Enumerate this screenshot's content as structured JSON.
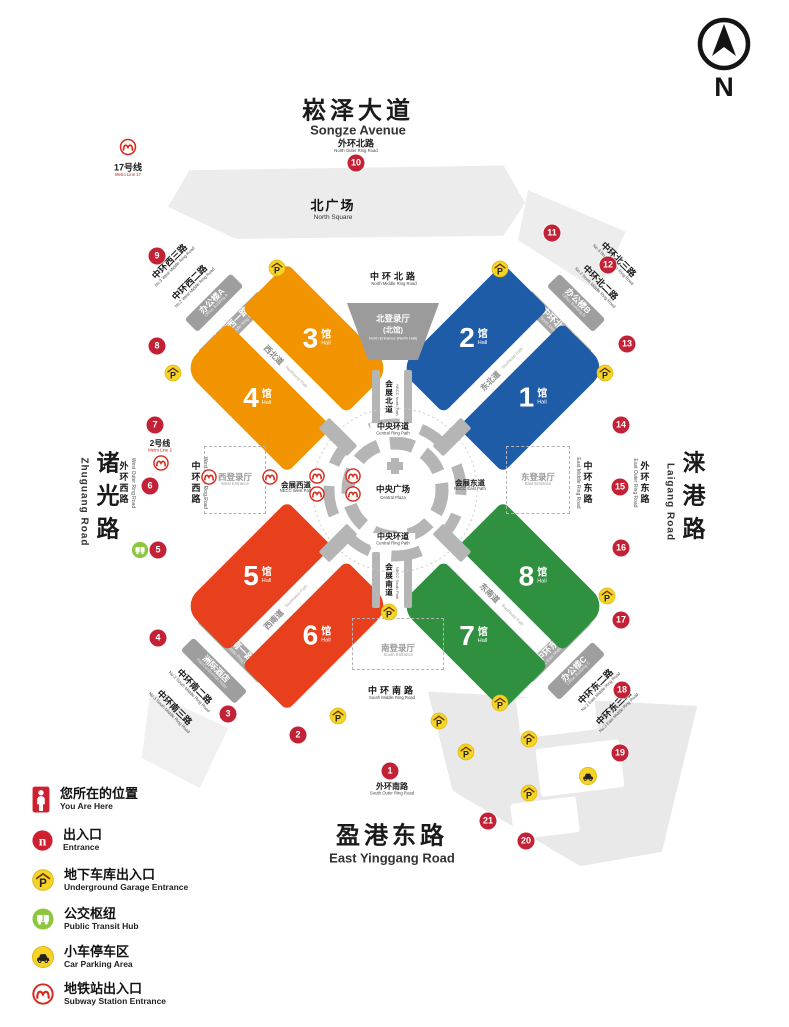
{
  "colors": {
    "hall_orange": "#F29400",
    "hall_blue": "#1E5CA8",
    "hall_red": "#E8401C",
    "hall_green": "#2F9140",
    "marker_red": "#C32236",
    "parking_yellow": "#F5D327",
    "bus_green": "#8DC63F",
    "metro_red": "#D52B1E",
    "road_gray": "#A8A8A8",
    "area_gray": "#ECECEC"
  },
  "compass": {
    "label": "N"
  },
  "icons": {
    "garage_letter": "P",
    "entrance_letter": "n"
  },
  "streets": {
    "top": {
      "zh": "崧泽大道",
      "en": "Songze Avenue"
    },
    "bottom": {
      "zh": "盈港东路",
      "en": "East Yinggang Road"
    },
    "left": {
      "zh": "诸光路",
      "en": "Zhuguang Road"
    },
    "right": {
      "zh": "涞港路",
      "en": "Laigang Road"
    }
  },
  "metro_lines": {
    "line17": {
      "zh": "17号线",
      "en": "Metro Line 17"
    },
    "line2": {
      "zh": "2号线",
      "en": "Metro Line 2"
    }
  },
  "areas": {
    "north_square": {
      "zh": "北广场",
      "en": "North Square"
    },
    "central_plaza": {
      "zh": "中央广场",
      "en": "Central Plaza"
    }
  },
  "entrances": {
    "north": {
      "zh": "北登录厅",
      "zh2": "(北馆)",
      "en": "North Entrance (North Hall)"
    },
    "west": {
      "zh": "西登录厅",
      "en": "West Entrance"
    },
    "east": {
      "zh": "东登录厅",
      "en": "East Entrance"
    },
    "south": {
      "zh": "南登录厅",
      "en": "South Entrance"
    }
  },
  "halls": {
    "h1": {
      "num": "1"
    },
    "h2": {
      "num": "2"
    },
    "h3": {
      "num": "3"
    },
    "h4": {
      "num": "4"
    },
    "h5": {
      "num": "5"
    },
    "h6": {
      "num": "6"
    },
    "h7": {
      "num": "7"
    },
    "h8": {
      "num": "8"
    }
  },
  "hall_unit": {
    "zh": "馆",
    "en": "Hall"
  },
  "ring_roads": {
    "outer_north": {
      "zh": "外环北路",
      "en": "North Outer Ring Road"
    },
    "outer_south": {
      "zh": "外环南路",
      "en": "South Outer Ring Road"
    },
    "outer_west": {
      "zh": "外环西路",
      "en": "West Outer Ring Road"
    },
    "outer_east": {
      "zh": "外环东路",
      "en": "East Outer Ring Road"
    },
    "middle_north": {
      "zh": "中环北路",
      "en": "North Middle Ring Road"
    },
    "middle_south": {
      "zh": "中环南路",
      "en": "South Middle Ring Road"
    },
    "middle_west": {
      "zh": "中环西路",
      "en": "West Middle Ring Road"
    },
    "middle_east": {
      "zh": "中环东路",
      "en": "East Middle Ring Road"
    },
    "west1": {
      "zh": "中环西一路",
      "en": "No.1 West Middle Ring Road"
    },
    "west2": {
      "zh": "中环西二路",
      "en": "No.2 West Middle Ring Road"
    },
    "west3": {
      "zh": "中环西三路",
      "en": "No.3 West Middle Ring Road"
    },
    "north1": {
      "zh": "中环北一路",
      "en": "No.1 North Middle Ring Road"
    },
    "north2": {
      "zh": "中环北二路",
      "en": "No.2 North Middle Ring Road"
    },
    "north3": {
      "zh": "中环北三路",
      "en": "No.3 North Middle Ring Road"
    },
    "south1": {
      "zh": "中环南一路",
      "en": "No.1 South Middle Ring Road"
    },
    "south2": {
      "zh": "中环南二路",
      "en": "No.2 South Middle Ring Road"
    },
    "south3": {
      "zh": "中环南三路",
      "en": "No.3 South Middle Ring Road"
    },
    "east1": {
      "zh": "中环东一路",
      "en": "No.1 East Middle Ring Road"
    },
    "east2": {
      "zh": "中环东二路",
      "en": "No.2 East Middle Ring Road"
    },
    "east3": {
      "zh": "中环东三路",
      "en": "No.3 East Middle Ring Road"
    }
  },
  "paths": {
    "necc_west": {
      "zh": "会展西道",
      "en": "NECC West Path"
    },
    "necc_east": {
      "zh": "会展东道",
      "en": "NECC East Path"
    },
    "necc_north": {
      "zh": "会展北道",
      "en": "NECC North Path"
    },
    "necc_south": {
      "zh": "会展南道",
      "en": "NECC South Path"
    },
    "central_ring": {
      "zh": "中央环道",
      "en": "Central Ring Path"
    },
    "nw": {
      "zh": "西北道",
      "en": "Northwest Path"
    },
    "ne": {
      "zh": "东北道",
      "en": "Northeast Path"
    },
    "sw": {
      "zh": "西南道",
      "en": "Southwest Path"
    },
    "se": {
      "zh": "东南道",
      "en": "Southeast Path"
    }
  },
  "buildings": {
    "office_a": {
      "zh": "办公楼A",
      "en": "Office Building A"
    },
    "office_b": {
      "zh": "办公楼B",
      "en": "Office Building B"
    },
    "office_c": {
      "zh": "办公楼C",
      "en": "Office Building C"
    },
    "hotel": {
      "zh": "洲际酒店",
      "en": "InterContinental Hotel"
    }
  },
  "markers": [
    "1",
    "2",
    "3",
    "4",
    "5",
    "6",
    "7",
    "8",
    "9",
    "10",
    "11",
    "12",
    "13",
    "14",
    "15",
    "16",
    "17",
    "18",
    "19",
    "20",
    "21"
  ],
  "legend": [
    {
      "zh": "您所在的位置",
      "en": "You Are Here"
    },
    {
      "zh": "出入口",
      "en": "Entrance"
    },
    {
      "zh": "地下车库出入口",
      "en": "Underground Garage Entrance"
    },
    {
      "zh": "公交枢纽",
      "en": "Public Transit Hub"
    },
    {
      "zh": "小车停车区",
      "en": "Car Parking Area"
    },
    {
      "zh": "地铁站出入口",
      "en": "Subway Station Entrance"
    }
  ]
}
